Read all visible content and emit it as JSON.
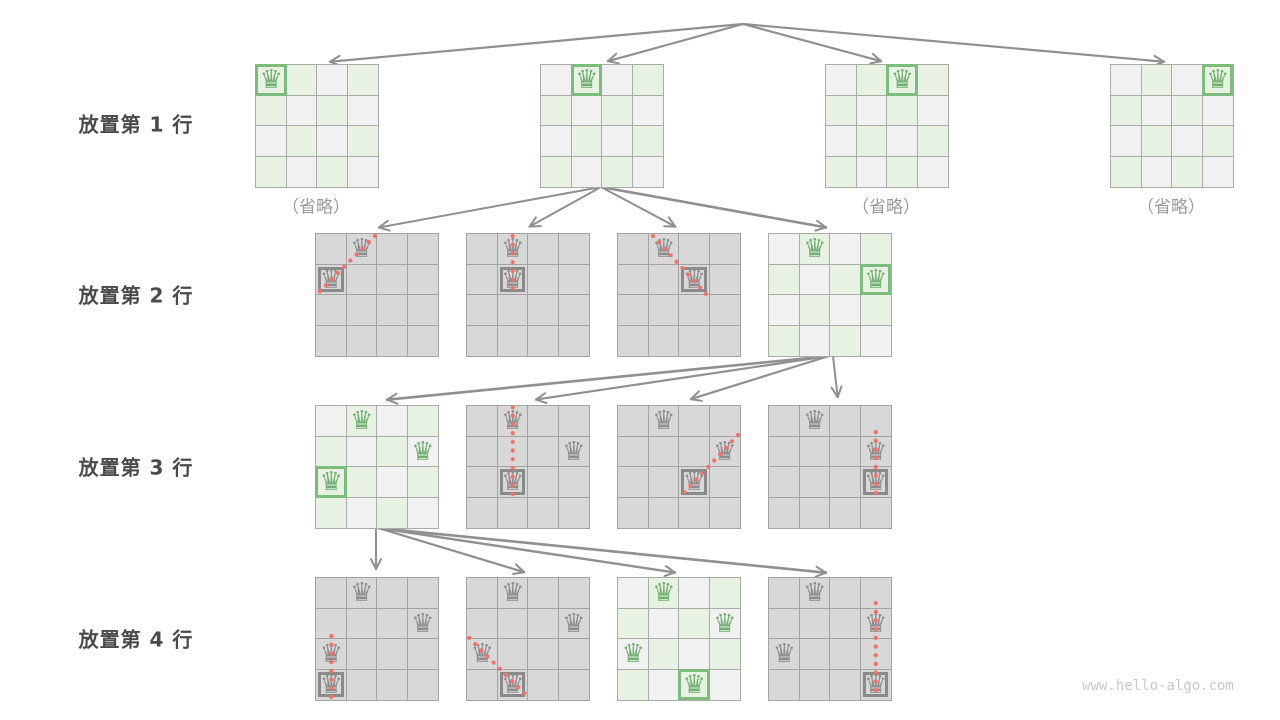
{
  "title": "n-queens backtracking search tree",
  "watermark": "www.hello-algo.com",
  "icons": {
    "queen_glyph": "♛"
  },
  "colors": {
    "background": "#ffffff",
    "cell_light_gray": "#f1f1f1",
    "cell_light_green": "#e8f2e3",
    "cell_gray": "#d8d8d8",
    "grid_light": "#a9adaa",
    "grid_gray": "#a3a3a3",
    "queen_green": "#72b072",
    "queen_gray": "#8d8d8d",
    "box_green": "#7cbc7c",
    "box_gray": "#8a8a8a",
    "arrow": "#909090",
    "conflict_dot": "#f4716b",
    "label_text": "#4a4a4a",
    "omitted_text": "#9b9b9b"
  },
  "geometry": {
    "board_size": 122,
    "cells_per_side": 4
  },
  "row_labels": [
    {
      "text": "放置第 1 行",
      "cx": 136,
      "cy": 123
    },
    {
      "text": "放置第 2 行",
      "cx": 136,
      "cy": 294
    },
    {
      "text": "放置第 3 行",
      "cx": 136,
      "cy": 466
    },
    {
      "text": "放置第 4 行",
      "cx": 136,
      "cy": 638
    }
  ],
  "omitted_labels": [
    {
      "text": "（省略）",
      "cx": 316,
      "cy": 205
    },
    {
      "text": "（省略）",
      "cx": 886,
      "cy": 205
    },
    {
      "text": "（省略）",
      "cx": 1171,
      "cy": 205
    }
  ],
  "boards": [
    {
      "name": "board-row1-col0",
      "x": 255,
      "y": 64,
      "style": "light",
      "queens": [
        {
          "r": 0,
          "c": 0,
          "color": "green",
          "boxed": true
        }
      ],
      "conflict": null
    },
    {
      "name": "board-row1-col1",
      "x": 540,
      "y": 64,
      "style": "light",
      "queens": [
        {
          "r": 0,
          "c": 1,
          "color": "green",
          "boxed": true
        }
      ],
      "conflict": null
    },
    {
      "name": "board-row1-col2",
      "x": 825,
      "y": 64,
      "style": "light",
      "queens": [
        {
          "r": 0,
          "c": 2,
          "color": "green",
          "boxed": true
        }
      ],
      "conflict": null
    },
    {
      "name": "board-row1-col3",
      "x": 1110,
      "y": 64,
      "style": "light",
      "queens": [
        {
          "r": 0,
          "c": 3,
          "color": "green",
          "boxed": true
        }
      ],
      "conflict": null
    },
    {
      "name": "board-row2-col0-conflict",
      "x": 315,
      "y": 233,
      "style": "gray",
      "queens": [
        {
          "r": 0,
          "c": 1,
          "color": "gray",
          "boxed": false
        },
        {
          "r": 1,
          "c": 0,
          "color": "gray",
          "boxed": true
        }
      ],
      "conflict": [
        59,
        2,
        1,
        60
      ]
    },
    {
      "name": "board-row2-col1-conflict",
      "x": 466,
      "y": 233,
      "style": "gray",
      "queens": [
        {
          "r": 0,
          "c": 1,
          "color": "gray",
          "boxed": false
        },
        {
          "r": 1,
          "c": 1,
          "color": "gray",
          "boxed": true
        }
      ],
      "conflict": [
        45.75,
        2,
        45.75,
        60
      ]
    },
    {
      "name": "board-row2-col2-conflict",
      "x": 617,
      "y": 233,
      "style": "gray",
      "queens": [
        {
          "r": 0,
          "c": 1,
          "color": "gray",
          "boxed": false
        },
        {
          "r": 1,
          "c": 2,
          "color": "gray",
          "boxed": true
        }
      ],
      "conflict": [
        35,
        2,
        88,
        60
      ]
    },
    {
      "name": "board-row2-col3-valid",
      "x": 768,
      "y": 233,
      "style": "light",
      "queens": [
        {
          "r": 0,
          "c": 1,
          "color": "green",
          "boxed": false
        },
        {
          "r": 1,
          "c": 3,
          "color": "green",
          "boxed": true
        }
      ],
      "conflict": null
    },
    {
      "name": "board-row3-col0-valid",
      "x": 315,
      "y": 405,
      "style": "light",
      "queens": [
        {
          "r": 0,
          "c": 1,
          "color": "green",
          "boxed": false
        },
        {
          "r": 1,
          "c": 3,
          "color": "green",
          "boxed": false
        },
        {
          "r": 2,
          "c": 0,
          "color": "green",
          "boxed": true
        }
      ],
      "conflict": null
    },
    {
      "name": "board-row3-col1-conflict",
      "x": 466,
      "y": 405,
      "style": "gray",
      "queens": [
        {
          "r": 0,
          "c": 1,
          "color": "gray",
          "boxed": false
        },
        {
          "r": 1,
          "c": 3,
          "color": "gray",
          "boxed": false
        },
        {
          "r": 2,
          "c": 1,
          "color": "gray",
          "boxed": true
        }
      ],
      "conflict": [
        45.75,
        1,
        45.75,
        91
      ]
    },
    {
      "name": "board-row3-col2-conflict",
      "x": 617,
      "y": 405,
      "style": "gray",
      "queens": [
        {
          "r": 0,
          "c": 1,
          "color": "gray",
          "boxed": false
        },
        {
          "r": 1,
          "c": 3,
          "color": "gray",
          "boxed": false
        },
        {
          "r": 2,
          "c": 2,
          "color": "gray",
          "boxed": true
        }
      ],
      "conflict": [
        120,
        29,
        64,
        89
      ]
    },
    {
      "name": "board-row3-col3-conflict",
      "x": 768,
      "y": 405,
      "style": "gray",
      "queens": [
        {
          "r": 0,
          "c": 1,
          "color": "gray",
          "boxed": false
        },
        {
          "r": 1,
          "c": 3,
          "color": "gray",
          "boxed": false
        },
        {
          "r": 2,
          "c": 3,
          "color": "gray",
          "boxed": true
        }
      ],
      "conflict": [
        106.75,
        26,
        106.75,
        91
      ]
    },
    {
      "name": "board-row4-col0-conflict",
      "x": 315,
      "y": 577,
      "style": "gray",
      "queens": [
        {
          "r": 0,
          "c": 1,
          "color": "gray",
          "boxed": false
        },
        {
          "r": 1,
          "c": 3,
          "color": "gray",
          "boxed": false
        },
        {
          "r": 2,
          "c": 0,
          "color": "gray",
          "boxed": false
        },
        {
          "r": 3,
          "c": 0,
          "color": "gray",
          "boxed": true
        }
      ],
      "conflict": [
        15.25,
        58,
        15.25,
        119
      ]
    },
    {
      "name": "board-row4-col1-conflict",
      "x": 466,
      "y": 577,
      "style": "gray",
      "queens": [
        {
          "r": 0,
          "c": 1,
          "color": "gray",
          "boxed": false
        },
        {
          "r": 1,
          "c": 3,
          "color": "gray",
          "boxed": false
        },
        {
          "r": 2,
          "c": 0,
          "color": "gray",
          "boxed": false
        },
        {
          "r": 3,
          "c": 1,
          "color": "gray",
          "boxed": true
        }
      ],
      "conflict": [
        2,
        60,
        60,
        118
      ]
    },
    {
      "name": "board-row4-col2-solution",
      "x": 617,
      "y": 577,
      "style": "light",
      "queens": [
        {
          "r": 0,
          "c": 1,
          "color": "green",
          "boxed": false
        },
        {
          "r": 1,
          "c": 3,
          "color": "green",
          "boxed": false
        },
        {
          "r": 2,
          "c": 0,
          "color": "green",
          "boxed": false
        },
        {
          "r": 3,
          "c": 2,
          "color": "green",
          "boxed": true
        }
      ],
      "conflict": null
    },
    {
      "name": "board-row4-col3-conflict",
      "x": 768,
      "y": 577,
      "style": "gray",
      "queens": [
        {
          "r": 0,
          "c": 1,
          "color": "gray",
          "boxed": false
        },
        {
          "r": 1,
          "c": 3,
          "color": "gray",
          "boxed": false
        },
        {
          "r": 2,
          "c": 0,
          "color": "gray",
          "boxed": false
        },
        {
          "r": 3,
          "c": 3,
          "color": "gray",
          "boxed": true
        }
      ],
      "conflict": [
        106.75,
        25,
        106.75,
        120
      ]
    }
  ],
  "arrows": [
    {
      "x1": 743,
      "y1": 24,
      "x2": 327,
      "y2": 62,
      "w": 2.2
    },
    {
      "x1": 743,
      "y1": 24,
      "x2": 605,
      "y2": 62,
      "w": 2.2
    },
    {
      "x1": 743,
      "y1": 24,
      "x2": 884,
      "y2": 62,
      "w": 2.2
    },
    {
      "x1": 743,
      "y1": 24,
      "x2": 1167,
      "y2": 62,
      "w": 2.2
    },
    {
      "x1": 601,
      "y1": 187,
      "x2": 376,
      "y2": 228,
      "w": 2
    },
    {
      "x1": 601,
      "y1": 187,
      "x2": 527,
      "y2": 228,
      "w": 2
    },
    {
      "x1": 601,
      "y1": 187,
      "x2": 678,
      "y2": 228,
      "w": 2
    },
    {
      "x1": 601,
      "y1": 187,
      "x2": 829,
      "y2": 228,
      "w": 2.6
    },
    {
      "x1": 829,
      "y1": 356,
      "x2": 384,
      "y2": 400,
      "w": 2.6
    },
    {
      "x1": 829,
      "y1": 356,
      "x2": 533,
      "y2": 400,
      "w": 2.2
    },
    {
      "x1": 829,
      "y1": 356,
      "x2": 688,
      "y2": 400,
      "w": 2.2
    },
    {
      "x1": 833,
      "y1": 356,
      "x2": 838,
      "y2": 400,
      "w": 2
    },
    {
      "x1": 376,
      "y1": 528,
      "x2": 376,
      "y2": 572,
      "w": 2
    },
    {
      "x1": 378,
      "y1": 528,
      "x2": 527,
      "y2": 573,
      "w": 2.2
    },
    {
      "x1": 378,
      "y1": 528,
      "x2": 678,
      "y2": 573,
      "w": 2.4
    },
    {
      "x1": 378,
      "y1": 528,
      "x2": 829,
      "y2": 573,
      "w": 2.6
    }
  ]
}
